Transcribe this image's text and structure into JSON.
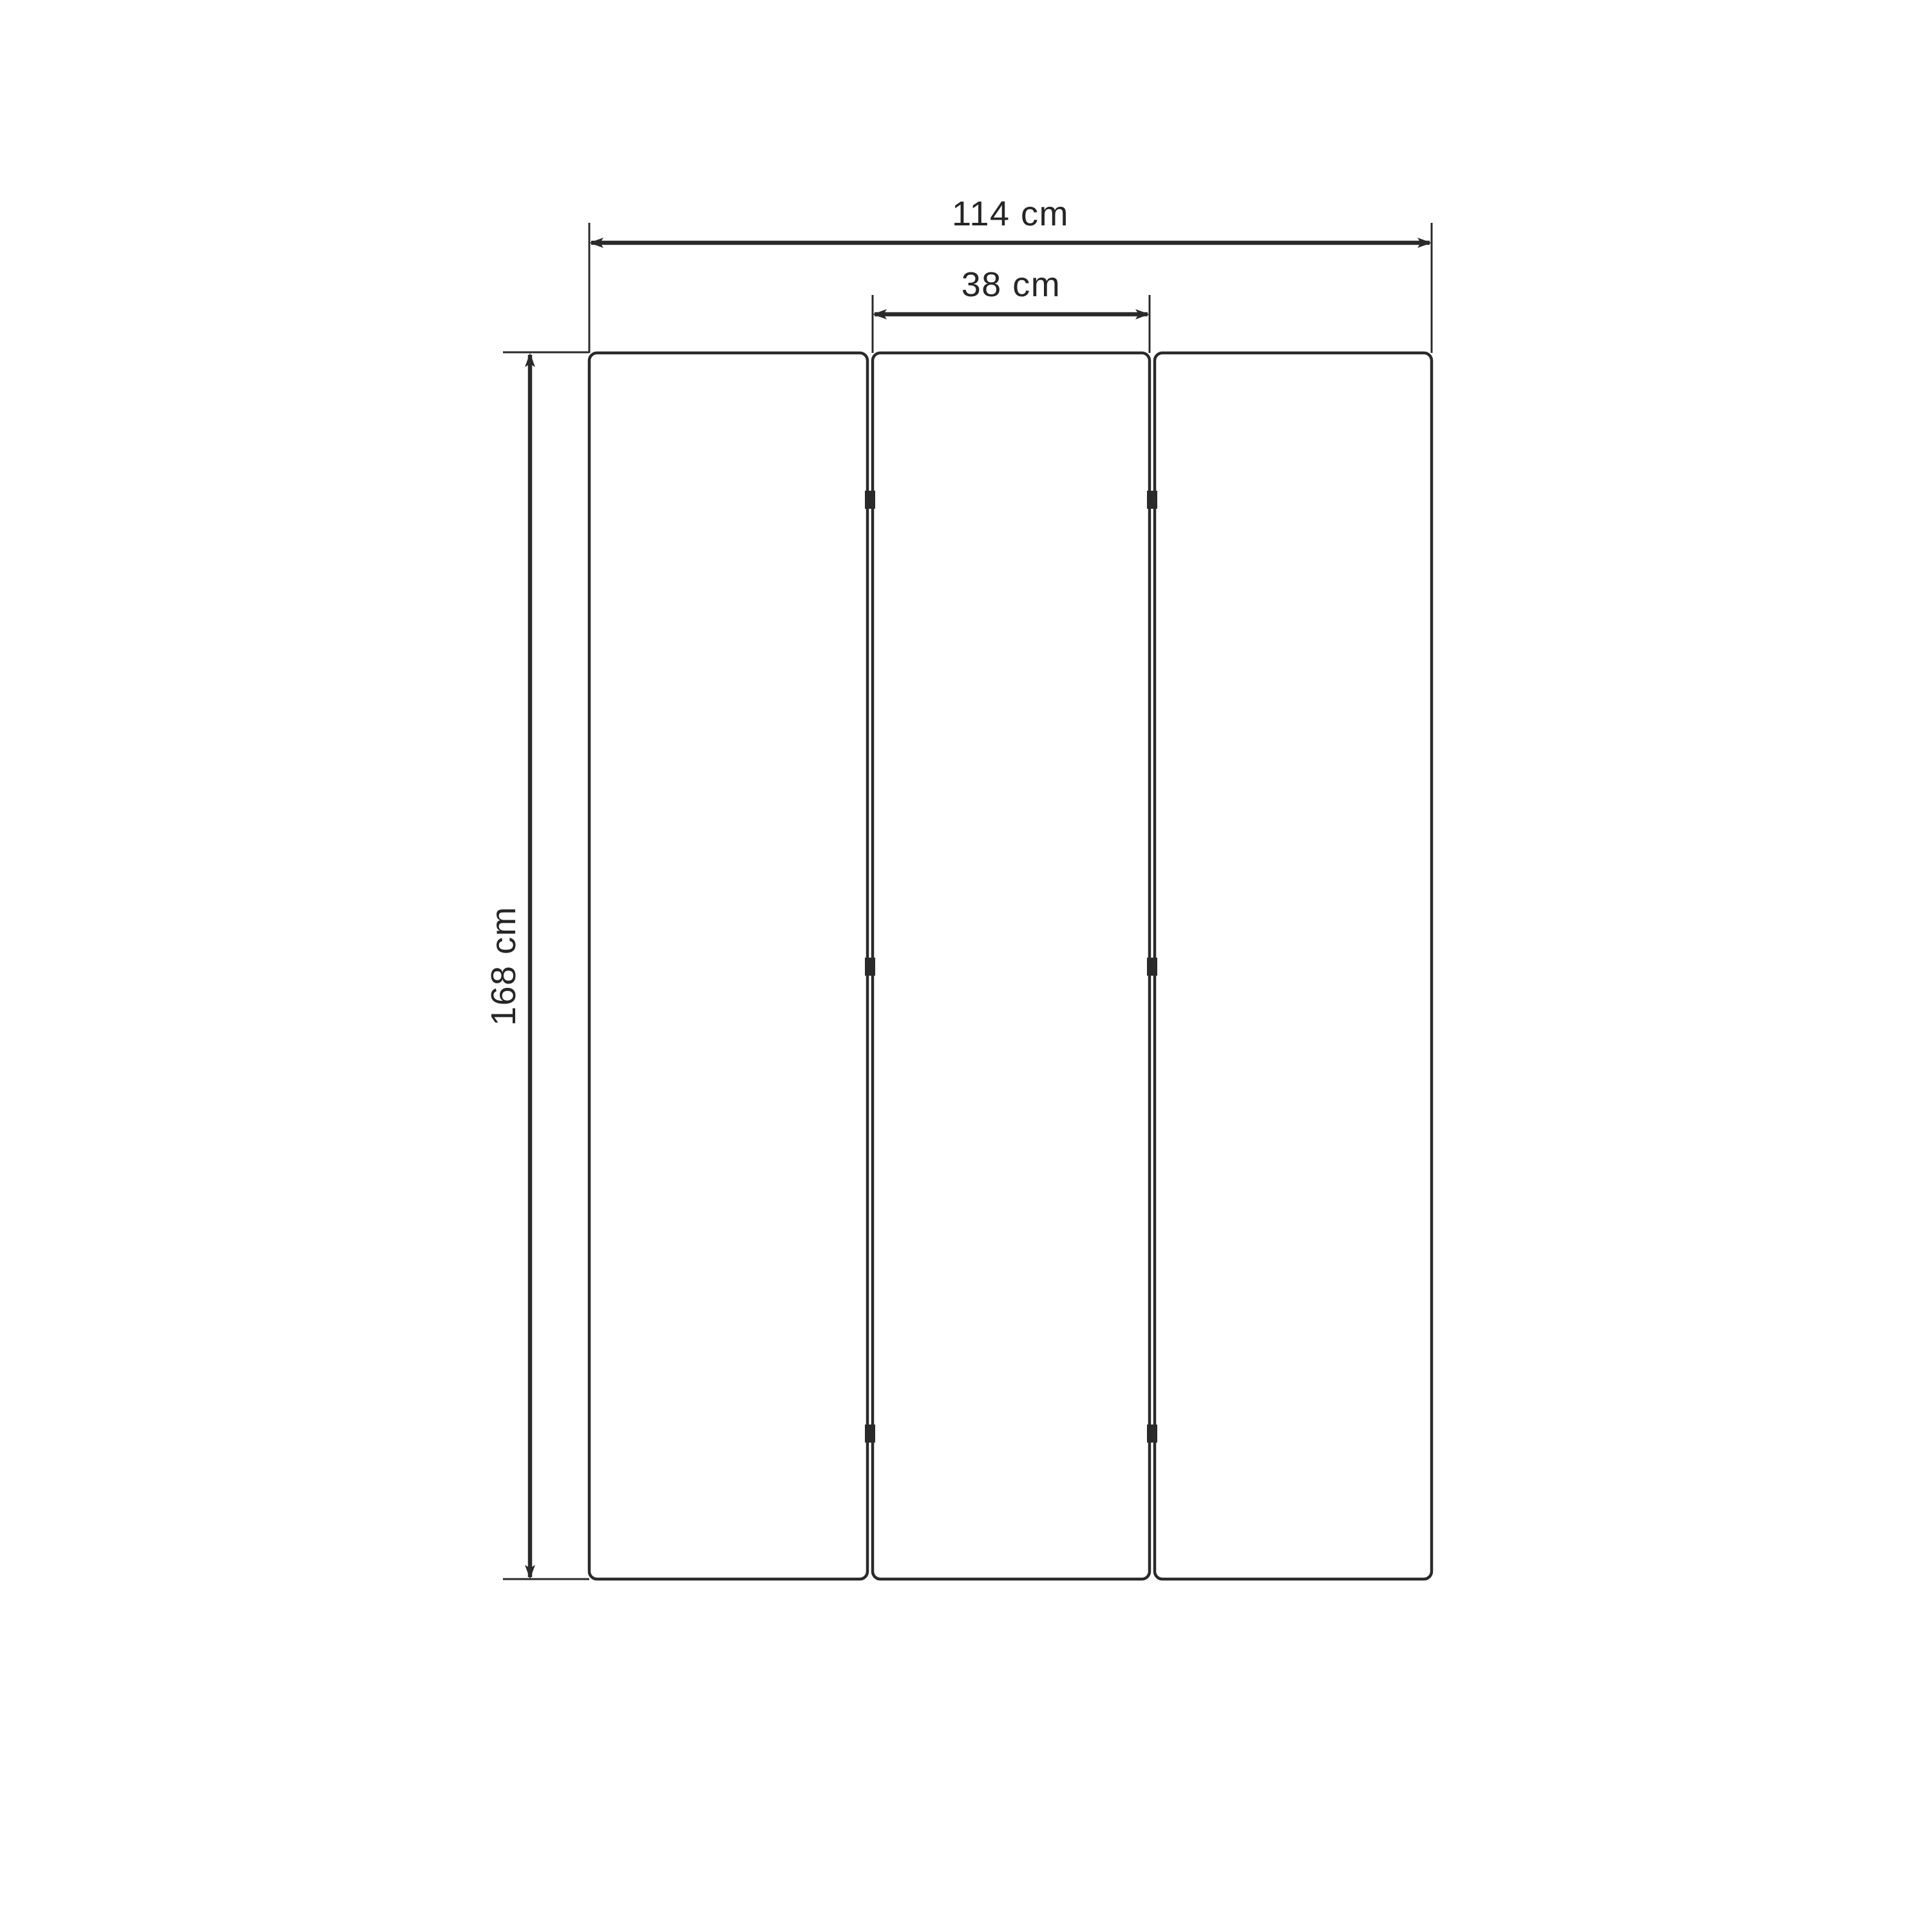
{
  "drawing": {
    "kind": "three-panel folding screen dimension drawing",
    "panel_count": 3,
    "hinge_marks_per_joint": 3,
    "colors": {
      "line": "#2a2a2a",
      "label_text": "#262626",
      "background": "#ffffff"
    },
    "dimensions": {
      "total_width": {
        "label": "114 cm",
        "value": 114,
        "unit": "cm"
      },
      "panel_width": {
        "label": "38 cm",
        "value": 38,
        "unit": "cm"
      },
      "height": {
        "label": "168 cm",
        "value": 168,
        "unit": "cm"
      }
    }
  }
}
